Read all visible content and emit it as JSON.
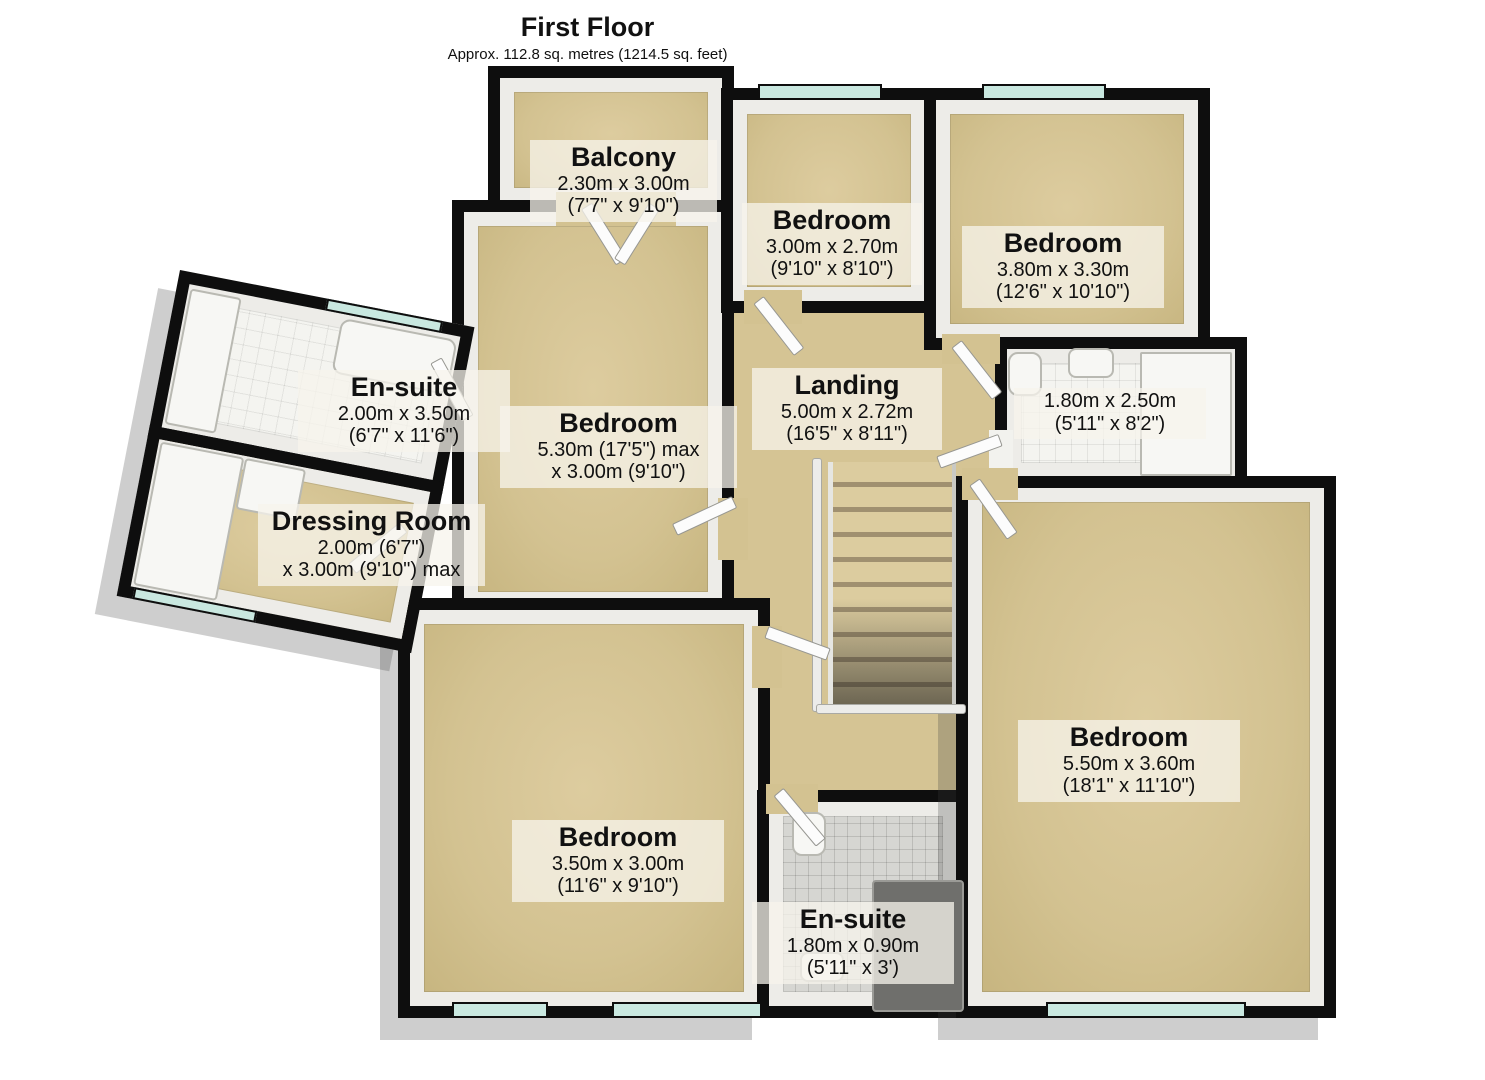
{
  "header": {
    "title": "First Floor",
    "subtitle": "Approx. 112.8 sq. metres (1214.5 sq. feet)"
  },
  "rooms": {
    "balcony": {
      "name": "Balcony",
      "dims": [
        "2.30m x 3.00m",
        "(7'7\" x 9'10\")"
      ]
    },
    "bedroom_top_middle": {
      "name": "Bedroom",
      "dims": [
        "3.00m x 2.70m",
        "(9'10\" x 8'10\")"
      ]
    },
    "bedroom_top_right": {
      "name": "Bedroom",
      "dims": [
        "3.80m x 3.30m",
        "(12'6\" x 10'10\")"
      ]
    },
    "ensuite_left": {
      "name": "En-suite",
      "dims": [
        "2.00m x 3.50m",
        "(6'7\" x 11'6\")"
      ]
    },
    "bedroom_mid_left": {
      "name": "Bedroom",
      "dims": [
        "5.30m (17'5\") max",
        "x 3.00m (9'10\")"
      ]
    },
    "landing": {
      "name": "Landing",
      "dims": [
        "5.00m x 2.72m",
        "(16'5\" x 8'11\")"
      ]
    },
    "bathroom": {
      "name": "",
      "dims": [
        "1.80m x 2.50m",
        "(5'11\" x 8'2\")"
      ]
    },
    "dressing_room": {
      "name": "Dressing Room",
      "dims": [
        "2.00m (6'7\")",
        "x 3.00m (9'10\") max"
      ]
    },
    "bedroom_bottom_left": {
      "name": "Bedroom",
      "dims": [
        "3.50m x 3.00m",
        "(11'6\" x 9'10\")"
      ]
    },
    "bedroom_bottom_right": {
      "name": "Bedroom",
      "dims": [
        "5.50m x 3.60m",
        "(18'1\" x 11'10\")"
      ]
    },
    "ensuite_bottom": {
      "name": "En-suite",
      "dims": [
        "1.80m x 0.90m",
        "(5'11\" x 3')"
      ]
    }
  },
  "colors": {
    "wall": "#0e0e0e",
    "floor_carpet": "#d3c291",
    "window_glass": "#c9e8e0",
    "tile_white": "#f4f4f0",
    "tile_grey": "#d6d6d2",
    "label_background": "rgba(247,244,236,0.75)"
  }
}
